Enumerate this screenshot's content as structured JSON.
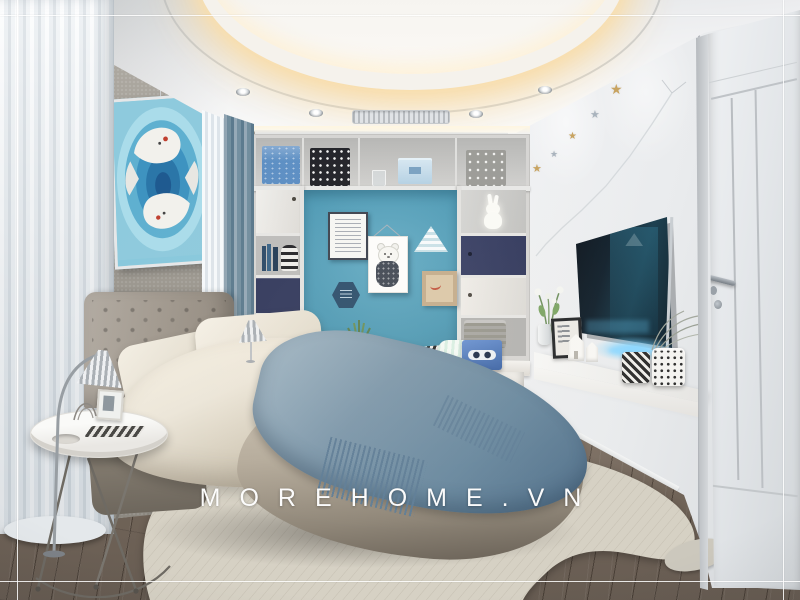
{
  "watermark": {
    "text": "MOREHOME.VN"
  },
  "garland": {
    "star_glyph": "★"
  },
  "colors": {
    "accentWall": "#4f9ab5",
    "accentWallLight": "#66adc6",
    "navyCabinet": "#333a5e",
    "blanketBlue": "#7e98ab",
    "duvetCream": "#ece6d9",
    "headboardGray": "#a29a90",
    "rugBeige": "#d6d1c4",
    "ledGlow": "#8fd8ff",
    "ceilingGlow": "#f4ddb0",
    "starGold": "#c8a360",
    "starSilver": "#a9b3bd",
    "tvScreen": "#13222e",
    "frameLine": "rgba(255,255,255,0.85)"
  }
}
